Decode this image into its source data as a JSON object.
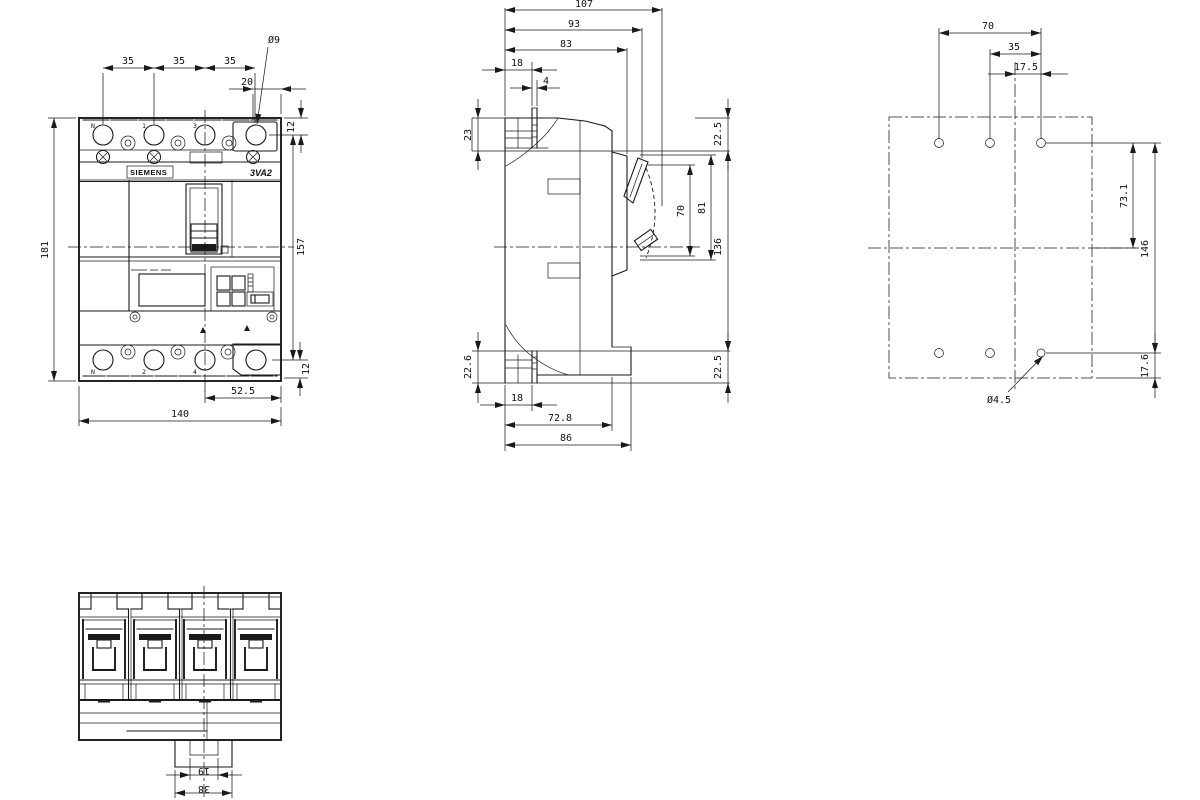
{
  "colors": {
    "ink": "#1a1a1a",
    "background": "#ffffff"
  },
  "labels": {
    "brand": "SIEMENS",
    "model": "3VA2",
    "terminals_top": [
      "N",
      "1",
      "3"
    ],
    "terminals_bottom": [
      "N",
      "2",
      "4"
    ]
  },
  "dims": {
    "front": {
      "pitch_a": "35",
      "pitch_b": "35",
      "pitch_c": "35",
      "hole_edge": "20",
      "hole_dia": "Ø9",
      "top_offset": "12",
      "overall_height": "181",
      "terminal_span": "157",
      "bottom_offset": "12",
      "box_span": "52.5",
      "overall_width": "140"
    },
    "side": {
      "depth_max": "107",
      "depth_handle": "93",
      "depth_escutcheon": "83",
      "clamp_depth": "18",
      "slot_width": "4",
      "top_back": "23",
      "top_front": "22.5",
      "handle_a": "70",
      "handle_b": "81",
      "body_span": "136",
      "bottom_back": "22.6",
      "bottom_front": "22.5",
      "foot_back": "18",
      "foot_depth": "72.8",
      "base_depth": "86"
    },
    "mount": {
      "hole_span": "70",
      "hole_half": "35",
      "hole_quarter": "17.5",
      "upper_span": "73.1",
      "vertical_span": "146",
      "lower_offset": "17.6",
      "hole_dia": "Ø4.5"
    },
    "bottom": {
      "notch_width": "19",
      "tab_width": "38"
    }
  }
}
